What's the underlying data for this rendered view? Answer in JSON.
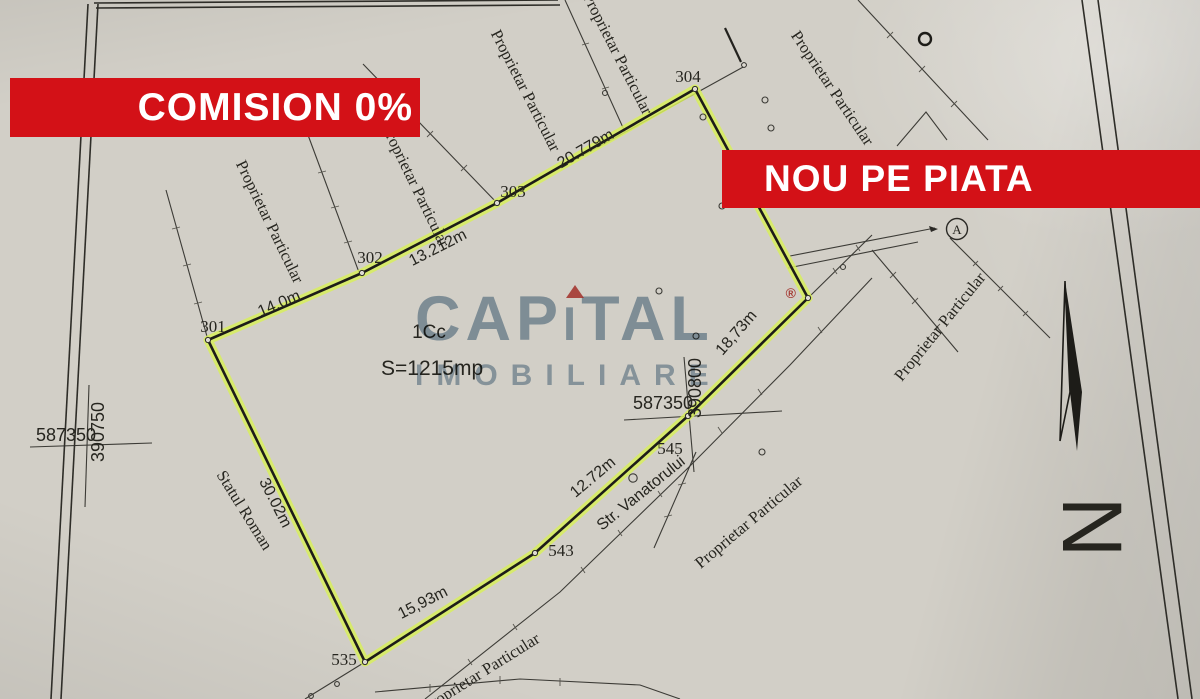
{
  "banners": {
    "comision": "COMISION 0%",
    "nou": "NOU PE PIATA",
    "red": "#d31117"
  },
  "watermark": {
    "part1": "CAP",
    "part2": "I",
    "part3": "TAL",
    "reg": "®",
    "sub": "IMOBILIARE",
    "blue": "#55789 4",
    "accent_red": "#c43a34"
  },
  "parcel": {
    "code": "1Cc",
    "area": "S=1215mp",
    "highlight_color": "#d8ee5c"
  },
  "points": {
    "p301": "301",
    "p302": "302",
    "p303": "303",
    "p304": "304",
    "p535": "535",
    "p543": "543",
    "p545": "545"
  },
  "measurements": {
    "m301_302": "14.0m",
    "m302_303": "13.212m",
    "m303_304": "20.779m",
    "m304_545": "18,73m",
    "m545_543": "12.72m",
    "m543_535": "15,93m",
    "m301_535": "30.02m"
  },
  "grid": {
    "left_x": "587350",
    "left_y": "390750",
    "right_x": "587350",
    "right_y": "390800"
  },
  "owners": [
    "Proprietar Particular",
    "Proprietar Particular",
    "Proprietar Particular",
    "Proprietar Particular",
    "Proprietar Particular",
    "Proprietar Particular",
    "Proprietar Particular",
    "Proprietar Particular"
  ],
  "labels": {
    "state_owner": "Statul Roman",
    "street": "Str. Vanatorului",
    "marker_a": "A",
    "north": "N"
  }
}
